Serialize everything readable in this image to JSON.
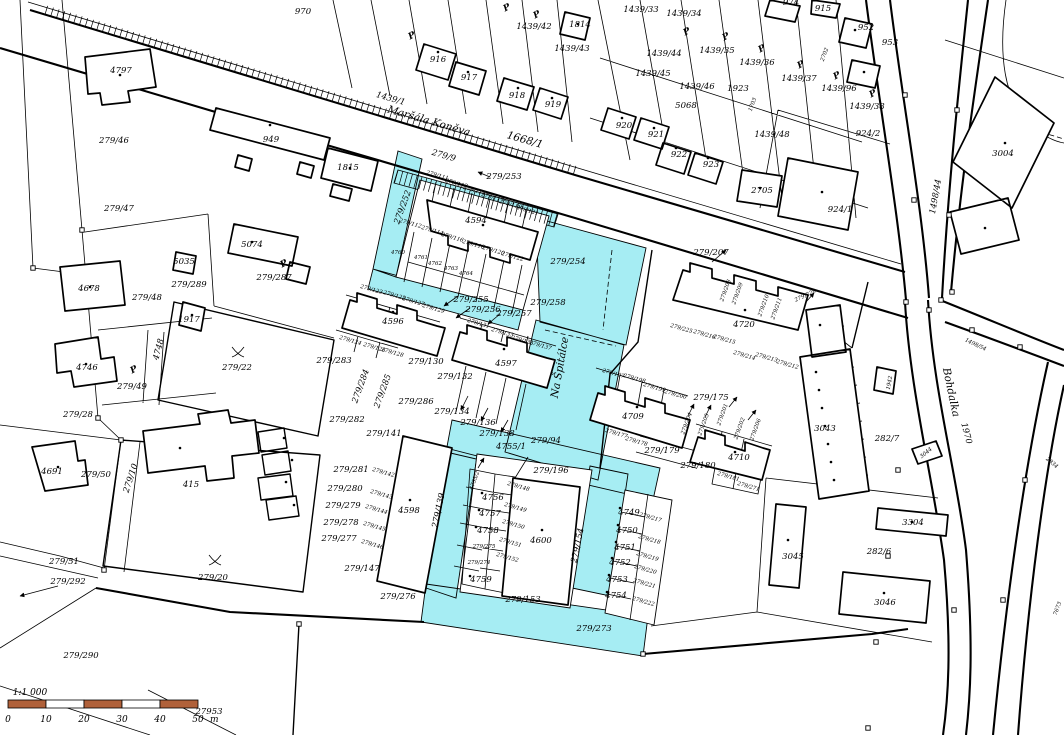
{
  "map": {
    "highlight_color": "#a6edf3",
    "scale": {
      "ratio": "1:1 000",
      "ticks": [
        "0",
        "10",
        "20",
        "30",
        "40",
        "50"
      ],
      "unit": "m",
      "bar_color": "#b0613a",
      "segments": 5
    },
    "labels": [
      {
        "t": "970",
        "x": 303,
        "y": 14
      },
      {
        "t": "974",
        "x": 791,
        "y": 5
      },
      {
        "t": "915",
        "x": 823,
        "y": 11
      },
      {
        "t": "952",
        "x": 866,
        "y": 30
      },
      {
        "t": "953",
        "x": 890,
        "y": 45
      },
      {
        "t": "1814",
        "x": 580,
        "y": 27
      },
      {
        "t": "1439/42",
        "x": 534,
        "y": 29
      },
      {
        "t": "1439/43",
        "x": 572,
        "y": 51
      },
      {
        "t": "1439/44",
        "x": 664,
        "y": 56
      },
      {
        "t": "1439/33",
        "x": 641,
        "y": 12
      },
      {
        "t": "1439/34",
        "x": 684,
        "y": 16
      },
      {
        "t": "1439/35",
        "x": 717,
        "y": 53
      },
      {
        "t": "1439/36",
        "x": 757,
        "y": 65
      },
      {
        "t": "1439/37",
        "x": 799,
        "y": 81
      },
      {
        "t": "1439/96",
        "x": 839,
        "y": 91
      },
      {
        "t": "1439/38",
        "x": 867,
        "y": 109
      },
      {
        "t": "1439/45",
        "x": 653,
        "y": 76
      },
      {
        "t": "1439/46",
        "x": 697,
        "y": 89
      },
      {
        "t": "5068",
        "x": 686,
        "y": 108
      },
      {
        "t": "1923",
        "x": 738,
        "y": 91
      },
      {
        "t": "1439/48",
        "x": 772,
        "y": 137
      },
      {
        "t": "2705",
        "x": 762,
        "y": 193
      },
      {
        "t": "924/2",
        "x": 868,
        "y": 136
      },
      {
        "t": "924/1",
        "x": 840,
        "y": 212
      },
      {
        "t": "916",
        "x": 438,
        "y": 62
      },
      {
        "t": "917",
        "x": 469,
        "y": 80
      },
      {
        "t": "918",
        "x": 517,
        "y": 98
      },
      {
        "t": "919",
        "x": 553,
        "y": 107
      },
      {
        "t": "920",
        "x": 624,
        "y": 128
      },
      {
        "t": "921",
        "x": 656,
        "y": 137
      },
      {
        "t": "922",
        "x": 679,
        "y": 157
      },
      {
        "t": "923",
        "x": 711,
        "y": 167
      },
      {
        "t": "2702",
        "x": 826,
        "y": 55,
        "r": -70,
        "s": 0
      },
      {
        "t": "1703",
        "x": 754,
        "y": 105,
        "r": -70,
        "s": 0
      },
      {
        "t": "3004",
        "x": 1003,
        "y": 156
      },
      {
        "t": "1439/1",
        "x": 390,
        "y": 101,
        "r": 16
      },
      {
        "t": "Maršála Koněva",
        "x": 428,
        "y": 124,
        "r": 16,
        "s": 2
      },
      {
        "t": "1668/1",
        "x": 524,
        "y": 143,
        "r": 16,
        "s": 2
      },
      {
        "t": "279/9",
        "x": 443,
        "y": 158,
        "r": 16
      },
      {
        "t": "4797",
        "x": 121,
        "y": 73
      },
      {
        "t": "279/46",
        "x": 114,
        "y": 143
      },
      {
        "t": "949",
        "x": 271,
        "y": 142
      },
      {
        "t": "1815",
        "x": 348,
        "y": 170
      },
      {
        "t": "279/47",
        "x": 119,
        "y": 211
      },
      {
        "t": "5074",
        "x": 252,
        "y": 247
      },
      {
        "t": "279/287",
        "x": 274,
        "y": 280
      },
      {
        "t": "279/289",
        "x": 189,
        "y": 287
      },
      {
        "t": "5035",
        "x": 184,
        "y": 264
      },
      {
        "t": "1917",
        "x": 189,
        "y": 322
      },
      {
        "t": "4678",
        "x": 89,
        "y": 291
      },
      {
        "t": "279/48",
        "x": 147,
        "y": 300
      },
      {
        "t": "4748",
        "x": 161,
        "y": 350,
        "r": -75
      },
      {
        "t": "4746",
        "x": 87,
        "y": 370
      },
      {
        "t": "279/49",
        "x": 132,
        "y": 389
      },
      {
        "t": "279/22",
        "x": 237,
        "y": 370
      },
      {
        "t": "279/28",
        "x": 78,
        "y": 417
      },
      {
        "t": "4691",
        "x": 52,
        "y": 474
      },
      {
        "t": "279/50",
        "x": 96,
        "y": 477
      },
      {
        "t": "279/51",
        "x": 64,
        "y": 564
      },
      {
        "t": "279/292",
        "x": 68,
        "y": 584
      },
      {
        "t": "415",
        "x": 191,
        "y": 487
      },
      {
        "t": "279/10",
        "x": 133,
        "y": 479,
        "r": -72
      },
      {
        "t": "279/290",
        "x": 81,
        "y": 658
      },
      {
        "t": "279/20",
        "x": 213,
        "y": 580
      },
      {
        "t": "279/253",
        "x": 504,
        "y": 179
      },
      {
        "t": "279/252",
        "x": 405,
        "y": 208,
        "r": -70
      },
      {
        "t": "4594",
        "x": 476,
        "y": 223
      },
      {
        "t": "279/111",
        "x": 437,
        "y": 177,
        "r": 16,
        "s": 0
      },
      {
        "t": "279/113",
        "x": 456,
        "y": 185,
        "r": 16,
        "s": 0
      },
      {
        "t": "279/115",
        "x": 474,
        "y": 192,
        "r": 16,
        "s": 0
      },
      {
        "t": "279/117",
        "x": 492,
        "y": 199,
        "r": 16,
        "s": 0
      },
      {
        "t": "279/119",
        "x": 510,
        "y": 206,
        "r": 16,
        "s": 0
      },
      {
        "t": "279/121",
        "x": 527,
        "y": 212,
        "r": 16,
        "s": 0
      },
      {
        "t": "279/112",
        "x": 410,
        "y": 225,
        "r": 16,
        "s": 0
      },
      {
        "t": "279/114",
        "x": 432,
        "y": 232,
        "r": 16,
        "s": 0
      },
      {
        "t": "279/116",
        "x": 452,
        "y": 239,
        "r": 16,
        "s": 0
      },
      {
        "t": "279/118",
        "x": 473,
        "y": 246,
        "r": 16,
        "s": 0
      },
      {
        "t": "279/120",
        "x": 493,
        "y": 252,
        "r": 16,
        "s": 0
      },
      {
        "t": "279/122",
        "x": 512,
        "y": 258,
        "r": 16,
        "s": 0
      },
      {
        "t": "4760",
        "x": 398,
        "y": 254,
        "s": 0
      },
      {
        "t": "4761",
        "x": 421,
        "y": 259,
        "s": 0
      },
      {
        "t": "4762",
        "x": 435,
        "y": 265,
        "s": 0
      },
      {
        "t": "4763",
        "x": 451,
        "y": 270,
        "s": 0
      },
      {
        "t": "4764",
        "x": 466,
        "y": 275,
        "s": 0
      },
      {
        "t": "279/254",
        "x": 568,
        "y": 264
      },
      {
        "t": "279/255",
        "x": 471,
        "y": 302
      },
      {
        "t": "279/256",
        "x": 483,
        "y": 312
      },
      {
        "t": "279/257",
        "x": 514,
        "y": 316
      },
      {
        "t": "279/258",
        "x": 548,
        "y": 305
      },
      {
        "t": "4596",
        "x": 393,
        "y": 324
      },
      {
        "t": "279/123",
        "x": 371,
        "y": 291,
        "r": 16,
        "s": 0
      },
      {
        "t": "279/125",
        "x": 394,
        "y": 297,
        "r": 16,
        "s": 0
      },
      {
        "t": "279/127",
        "x": 413,
        "y": 303,
        "r": 16,
        "s": 0
      },
      {
        "t": "279/129",
        "x": 433,
        "y": 310,
        "r": 16,
        "s": 0
      },
      {
        "t": "279/124",
        "x": 350,
        "y": 342,
        "r": 16,
        "s": 0
      },
      {
        "t": "279/126",
        "x": 374,
        "y": 349,
        "r": 16,
        "s": 0
      },
      {
        "t": "279/128",
        "x": 392,
        "y": 354,
        "r": 16,
        "s": 0
      },
      {
        "t": "279/283",
        "x": 334,
        "y": 363
      },
      {
        "t": "279/284",
        "x": 363,
        "y": 387,
        "r": -70
      },
      {
        "t": "279/285",
        "x": 385,
        "y": 392,
        "r": -70
      },
      {
        "t": "279/286",
        "x": 416,
        "y": 404
      },
      {
        "t": "279/282",
        "x": 347,
        "y": 422
      },
      {
        "t": "279/130",
        "x": 426,
        "y": 364
      },
      {
        "t": "279/132",
        "x": 455,
        "y": 379
      },
      {
        "t": "4597",
        "x": 506,
        "y": 366
      },
      {
        "t": "279/131",
        "x": 478,
        "y": 325,
        "r": 16,
        "s": 0
      },
      {
        "t": "279/133",
        "x": 502,
        "y": 334,
        "r": 16,
        "s": 0
      },
      {
        "t": "279/135",
        "x": 522,
        "y": 342,
        "r": 16,
        "s": 0
      },
      {
        "t": "279/137",
        "x": 540,
        "y": 347,
        "r": 16,
        "s": 0
      },
      {
        "t": "Na Špitálce",
        "x": 563,
        "y": 368,
        "r": -80,
        "s": 2
      },
      {
        "t": "279/134",
        "x": 452,
        "y": 414
      },
      {
        "t": "279/136",
        "x": 478,
        "y": 425
      },
      {
        "t": "279/138",
        "x": 497,
        "y": 436
      },
      {
        "t": "279/94",
        "x": 546,
        "y": 443
      },
      {
        "t": "4755/1",
        "x": 511,
        "y": 449
      },
      {
        "t": "4755/2",
        "x": 476,
        "y": 481,
        "r": -70,
        "s": 0
      },
      {
        "t": "279/196",
        "x": 551,
        "y": 473
      },
      {
        "t": "4756",
        "x": 493,
        "y": 500
      },
      {
        "t": "4757",
        "x": 490,
        "y": 516
      },
      {
        "t": "4758",
        "x": 488,
        "y": 533
      },
      {
        "t": "4759",
        "x": 481,
        "y": 582
      },
      {
        "t": "279/148",
        "x": 518,
        "y": 488,
        "r": 16,
        "s": 0
      },
      {
        "t": "279/149",
        "x": 515,
        "y": 509,
        "r": 16,
        "s": 0
      },
      {
        "t": "279/150",
        "x": 513,
        "y": 526,
        "r": 16,
        "s": 0
      },
      {
        "t": "279/151",
        "x": 510,
        "y": 544,
        "r": 16,
        "s": 0
      },
      {
        "t": "279/152",
        "x": 507,
        "y": 559,
        "r": 16,
        "s": 0
      },
      {
        "t": "279/275",
        "x": 484,
        "y": 548,
        "s": 0
      },
      {
        "t": "279/274",
        "x": 479,
        "y": 564,
        "s": 0
      },
      {
        "t": "4600",
        "x": 541,
        "y": 543
      },
      {
        "t": "279/154",
        "x": 580,
        "y": 546,
        "r": -78
      },
      {
        "t": "279/153",
        "x": 523,
        "y": 602
      },
      {
        "t": "279/273",
        "x": 594,
        "y": 631
      },
      {
        "t": "279/276",
        "x": 398,
        "y": 599
      },
      {
        "t": "279/147",
        "x": 362,
        "y": 571
      },
      {
        "t": "4598",
        "x": 409,
        "y": 513
      },
      {
        "t": "279/139",
        "x": 441,
        "y": 511,
        "r": -78
      },
      {
        "t": "279/141",
        "x": 384,
        "y": 436
      },
      {
        "t": "279/281",
        "x": 351,
        "y": 472
      },
      {
        "t": "279/142",
        "x": 383,
        "y": 474,
        "r": 16,
        "s": 0
      },
      {
        "t": "279/280",
        "x": 345,
        "y": 491
      },
      {
        "t": "279/143",
        "x": 381,
        "y": 496,
        "r": 16,
        "s": 0
      },
      {
        "t": "279/279",
        "x": 343,
        "y": 508
      },
      {
        "t": "279/144",
        "x": 376,
        "y": 511,
        "r": 16,
        "s": 0
      },
      {
        "t": "279/278",
        "x": 341,
        "y": 525
      },
      {
        "t": "279/145",
        "x": 374,
        "y": 528,
        "r": 16,
        "s": 0
      },
      {
        "t": "279/277",
        "x": 339,
        "y": 541
      },
      {
        "t": "279/146",
        "x": 372,
        "y": 546,
        "r": 16,
        "s": 0
      },
      {
        "t": "4749",
        "x": 629,
        "y": 515
      },
      {
        "t": "4750",
        "x": 627,
        "y": 533
      },
      {
        "t": "4751",
        "x": 625,
        "y": 550
      },
      {
        "t": "4752",
        "x": 620,
        "y": 565
      },
      {
        "t": "4753",
        "x": 617,
        "y": 582
      },
      {
        "t": "4754",
        "x": 616,
        "y": 598
      },
      {
        "t": "279/217",
        "x": 650,
        "y": 519,
        "r": 16,
        "s": 0
      },
      {
        "t": "279/218",
        "x": 649,
        "y": 541,
        "r": 16,
        "s": 0
      },
      {
        "t": "279/219",
        "x": 647,
        "y": 558,
        "r": 16,
        "s": 0
      },
      {
        "t": "279/220",
        "x": 645,
        "y": 571,
        "r": 16,
        "s": 0
      },
      {
        "t": "279/221",
        "x": 644,
        "y": 585,
        "r": 16,
        "s": 0
      },
      {
        "t": "279/222",
        "x": 643,
        "y": 603,
        "r": 16,
        "s": 0
      },
      {
        "t": "279/207",
        "x": 711,
        "y": 255
      },
      {
        "t": "4720",
        "x": 744,
        "y": 327
      },
      {
        "t": "279/208",
        "x": 727,
        "y": 291,
        "r": -70,
        "s": 0
      },
      {
        "t": "279/209",
        "x": 739,
        "y": 294,
        "r": -70,
        "s": 0
      },
      {
        "t": "279/210",
        "x": 765,
        "y": 306,
        "r": -70,
        "s": 0
      },
      {
        "t": "279/211",
        "x": 778,
        "y": 309,
        "r": -70,
        "s": 0
      },
      {
        "t": "279/228",
        "x": 806,
        "y": 297,
        "r": -25,
        "s": 0
      },
      {
        "t": "279/225",
        "x": 681,
        "y": 330,
        "r": 16,
        "s": 0
      },
      {
        "t": "279/216",
        "x": 704,
        "y": 336,
        "r": 16,
        "s": 0
      },
      {
        "t": "279/215",
        "x": 724,
        "y": 341,
        "r": 16,
        "s": 0
      },
      {
        "t": "279/214",
        "x": 744,
        "y": 357,
        "r": 16,
        "s": 0
      },
      {
        "t": "279/213",
        "x": 766,
        "y": 359,
        "r": 16,
        "s": 0
      },
      {
        "t": "279/212",
        "x": 787,
        "y": 366,
        "r": 16,
        "s": 0
      },
      {
        "t": "4709",
        "x": 633,
        "y": 419
      },
      {
        "t": "279/197",
        "x": 613,
        "y": 375,
        "r": 16,
        "s": 0
      },
      {
        "t": "279/198",
        "x": 634,
        "y": 380,
        "r": 16,
        "s": 0
      },
      {
        "t": "279/199",
        "x": 654,
        "y": 389,
        "r": 16,
        "s": 0
      },
      {
        "t": "279/200",
        "x": 675,
        "y": 396,
        "r": 16,
        "s": 0
      },
      {
        "t": "279/204",
        "x": 688,
        "y": 424,
        "r": -70,
        "s": 0
      },
      {
        "t": "279/205",
        "x": 705,
        "y": 425,
        "r": -70,
        "s": 0
      },
      {
        "t": "279/175",
        "x": 711,
        "y": 400
      },
      {
        "t": "279/201",
        "x": 724,
        "y": 415,
        "r": -70,
        "s": 0
      },
      {
        "t": "279/202",
        "x": 741,
        "y": 429,
        "r": -70,
        "s": 0
      },
      {
        "t": "279/206",
        "x": 757,
        "y": 430,
        "r": -70,
        "s": 0
      },
      {
        "t": "4710",
        "x": 739,
        "y": 460
      },
      {
        "t": "279/179",
        "x": 662,
        "y": 453
      },
      {
        "t": "279/180",
        "x": 698,
        "y": 468
      },
      {
        "t": "279/177",
        "x": 616,
        "y": 435,
        "r": 16,
        "s": 0
      },
      {
        "t": "279/178",
        "x": 636,
        "y": 443,
        "r": 16,
        "s": 0
      },
      {
        "t": "279/181",
        "x": 728,
        "y": 478,
        "r": 16,
        "s": 0
      },
      {
        "t": "279/271",
        "x": 748,
        "y": 488,
        "r": 16,
        "s": 0
      },
      {
        "t": "3043",
        "x": 825,
        "y": 431
      },
      {
        "t": "282/7",
        "x": 887,
        "y": 441
      },
      {
        "t": "1942",
        "x": 891,
        "y": 383,
        "r": -80,
        "s": 0
      },
      {
        "t": "1498/44",
        "x": 938,
        "y": 197,
        "r": -80
      },
      {
        "t": "1498/54",
        "x": 975,
        "y": 346,
        "r": 25,
        "s": 0
      },
      {
        "t": "1970",
        "x": 964,
        "y": 434,
        "r": 75
      },
      {
        "t": "Bohdalka",
        "x": 948,
        "y": 393,
        "r": 78,
        "s": 2
      },
      {
        "t": "3044",
        "x": 927,
        "y": 454,
        "r": -40,
        "s": 0
      },
      {
        "t": "2834",
        "x": 1051,
        "y": 464,
        "r": 40,
        "s": 0
      },
      {
        "t": "3304",
        "x": 913,
        "y": 525
      },
      {
        "t": "282/6",
        "x": 879,
        "y": 554
      },
      {
        "t": "3045",
        "x": 793,
        "y": 559
      },
      {
        "t": "3046",
        "x": 885,
        "y": 605
      },
      {
        "t": "7673",
        "x": 1059,
        "y": 609,
        "r": -70,
        "s": 0
      },
      {
        "t": "27953",
        "x": 209,
        "y": 714
      }
    ],
    "symbols": {
      "p_marks": [
        [
          508,
          10
        ],
        [
          538,
          17
        ],
        [
          688,
          34
        ],
        [
          727,
          39
        ],
        [
          763,
          51
        ],
        [
          802,
          67
        ],
        [
          838,
          78
        ],
        [
          874,
          96
        ],
        [
          285,
          266
        ],
        [
          135,
          372
        ],
        [
          413,
          38
        ]
      ],
      "trees": [
        [
          238,
          352
        ],
        [
          215,
          560
        ]
      ]
    }
  }
}
